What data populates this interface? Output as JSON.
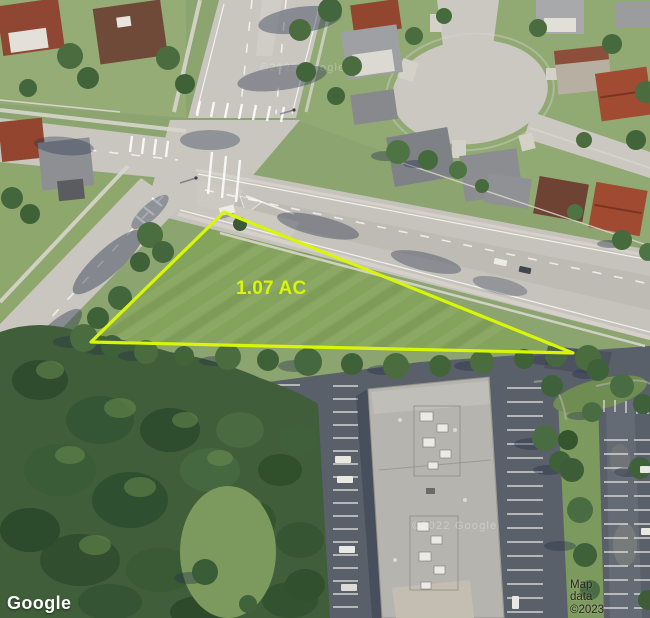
{
  "map": {
    "parcel": {
      "area_label": "1.07 AC",
      "outline_color": "#d8f606",
      "label_color": "#d8f606"
    },
    "attribution": {
      "logo_text": "Google",
      "map_data_text": "Map data ©2023"
    },
    "watermarks": {
      "top": "©2023 Google",
      "roof": "©2022 Google"
    }
  }
}
